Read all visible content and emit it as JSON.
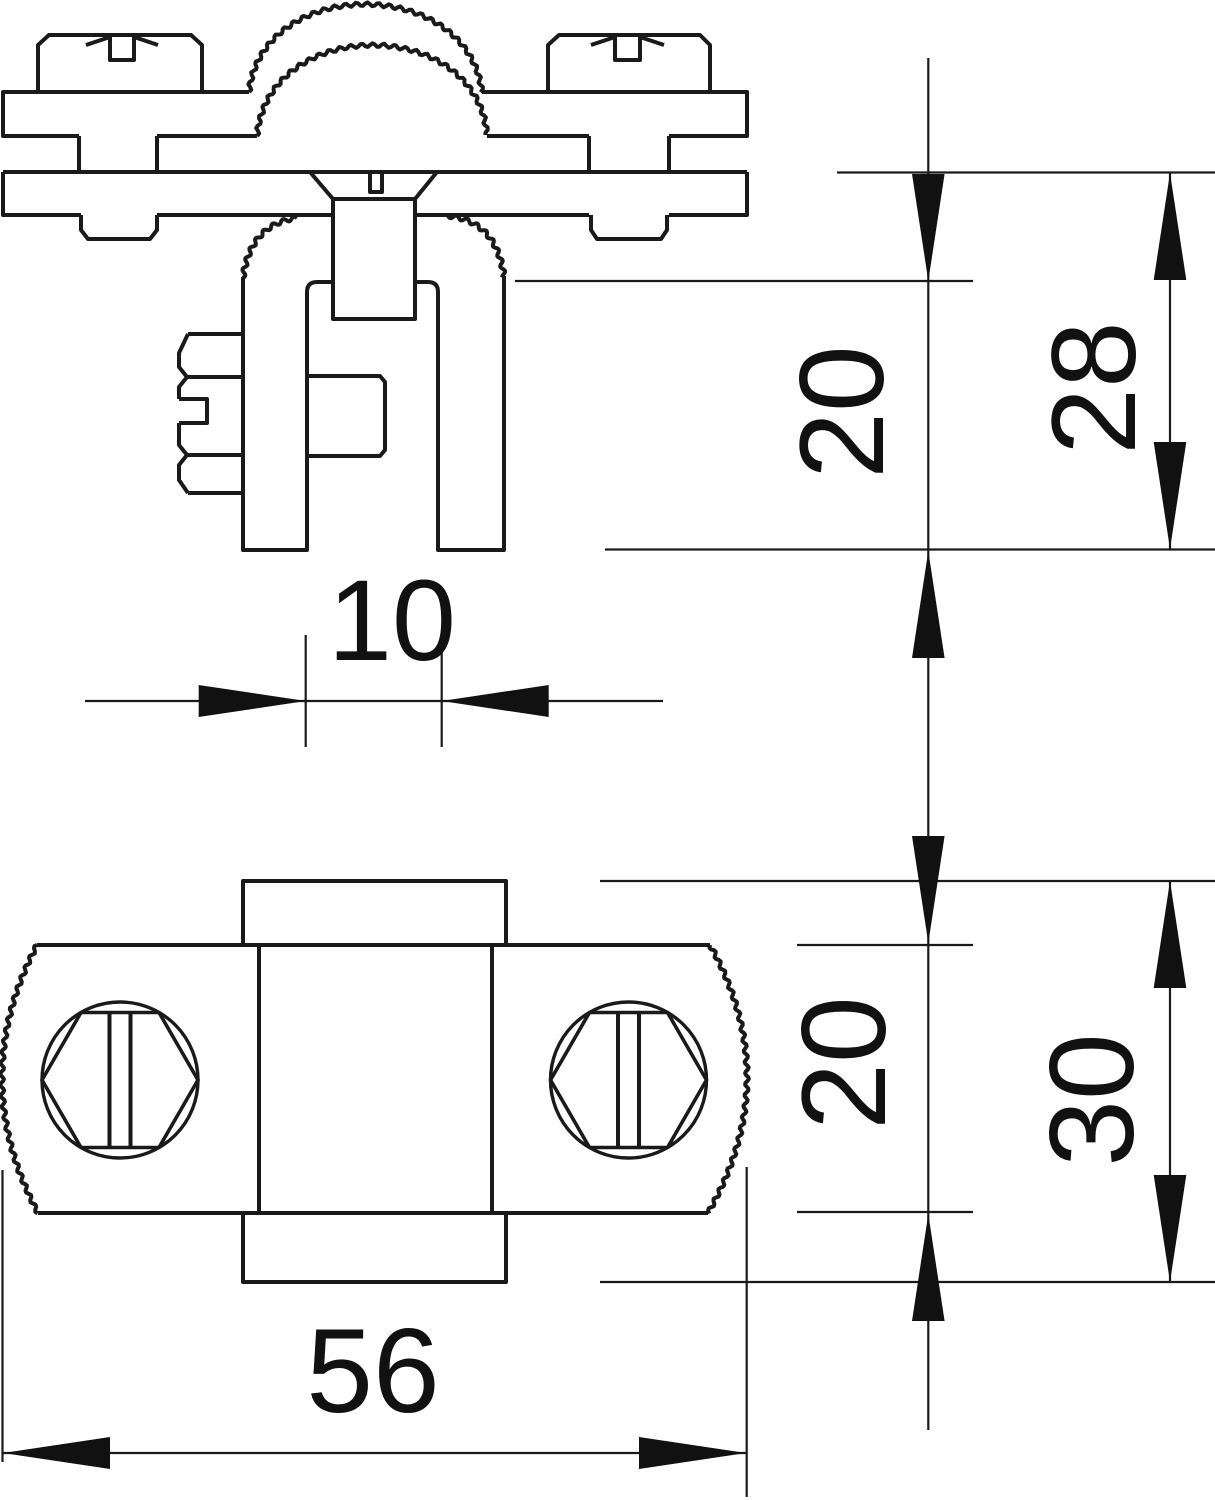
{
  "drawing": {
    "type": "technical-dimension-drawing",
    "background_color": "#ffffff",
    "line_color": "#1a1a1a",
    "views": {
      "front_view": {
        "name": "front elevation of clamp with saddle strap, slotted screws and clevis fork"
      },
      "plan_view": {
        "name": "plan view of clamp body with knurled ends and two slotted hex screws"
      }
    },
    "dimensions": {
      "slot_width": {
        "label": "10",
        "orientation": "horizontal",
        "applies_to": "fork slot width, front view"
      },
      "front_upper": {
        "label": "20",
        "orientation": "vertical",
        "applies_to": "fork slot depth, front view"
      },
      "front_total": {
        "label": "28",
        "orientation": "vertical",
        "applies_to": "fork height below plate, front view"
      },
      "plan_body": {
        "label": "20",
        "orientation": "vertical",
        "applies_to": "body depth, plan view"
      },
      "plan_total": {
        "label": "30",
        "orientation": "vertical",
        "applies_to": "overall depth incl. tabs, plan view"
      },
      "plan_width": {
        "label": "56",
        "orientation": "horizontal",
        "applies_to": "overall body width, plan view"
      }
    }
  }
}
